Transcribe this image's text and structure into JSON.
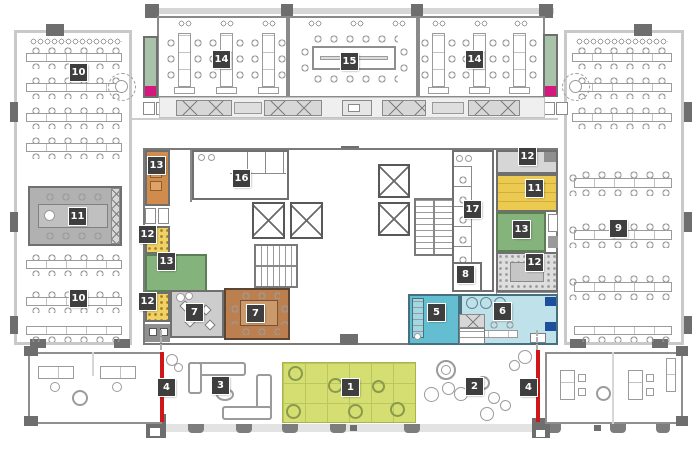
{
  "title": "Office floor plan",
  "colors": {
    "badge_bg": "#3e3e3e",
    "badge_text": "#ffffff",
    "sage": "#a9c3ab",
    "magenta": "#d6187d",
    "orange": "#d08c4c",
    "green": "#84b37b",
    "yellow": "#ecc94f",
    "yellow_dotted": "#eed266",
    "gray_room": "#b1b1b1",
    "brown": "#bc7f50",
    "brown_table": "#cb9a6a",
    "teal": "#64bed2",
    "light_blue": "#bfe1e9",
    "navy": "#1d4f9c",
    "lime": "#d5de71",
    "lime_line": "#bac75c",
    "red": "#cf1717"
  },
  "badges": [
    {
      "label": "1"
    },
    {
      "label": "2"
    },
    {
      "label": "3"
    },
    {
      "label": "4"
    },
    {
      "label": "4"
    },
    {
      "label": "5"
    },
    {
      "label": "6"
    },
    {
      "label": "7"
    },
    {
      "label": "7"
    },
    {
      "label": "8"
    },
    {
      "label": "9"
    },
    {
      "label": "10"
    },
    {
      "label": "10"
    },
    {
      "label": "11"
    },
    {
      "label": "11"
    },
    {
      "label": "12"
    },
    {
      "label": "12"
    },
    {
      "label": "12"
    },
    {
      "label": "12"
    },
    {
      "label": "13"
    },
    {
      "label": "13"
    },
    {
      "label": "13"
    },
    {
      "label": "14"
    },
    {
      "label": "14"
    },
    {
      "label": "15"
    },
    {
      "label": "16"
    },
    {
      "label": "17"
    }
  ]
}
